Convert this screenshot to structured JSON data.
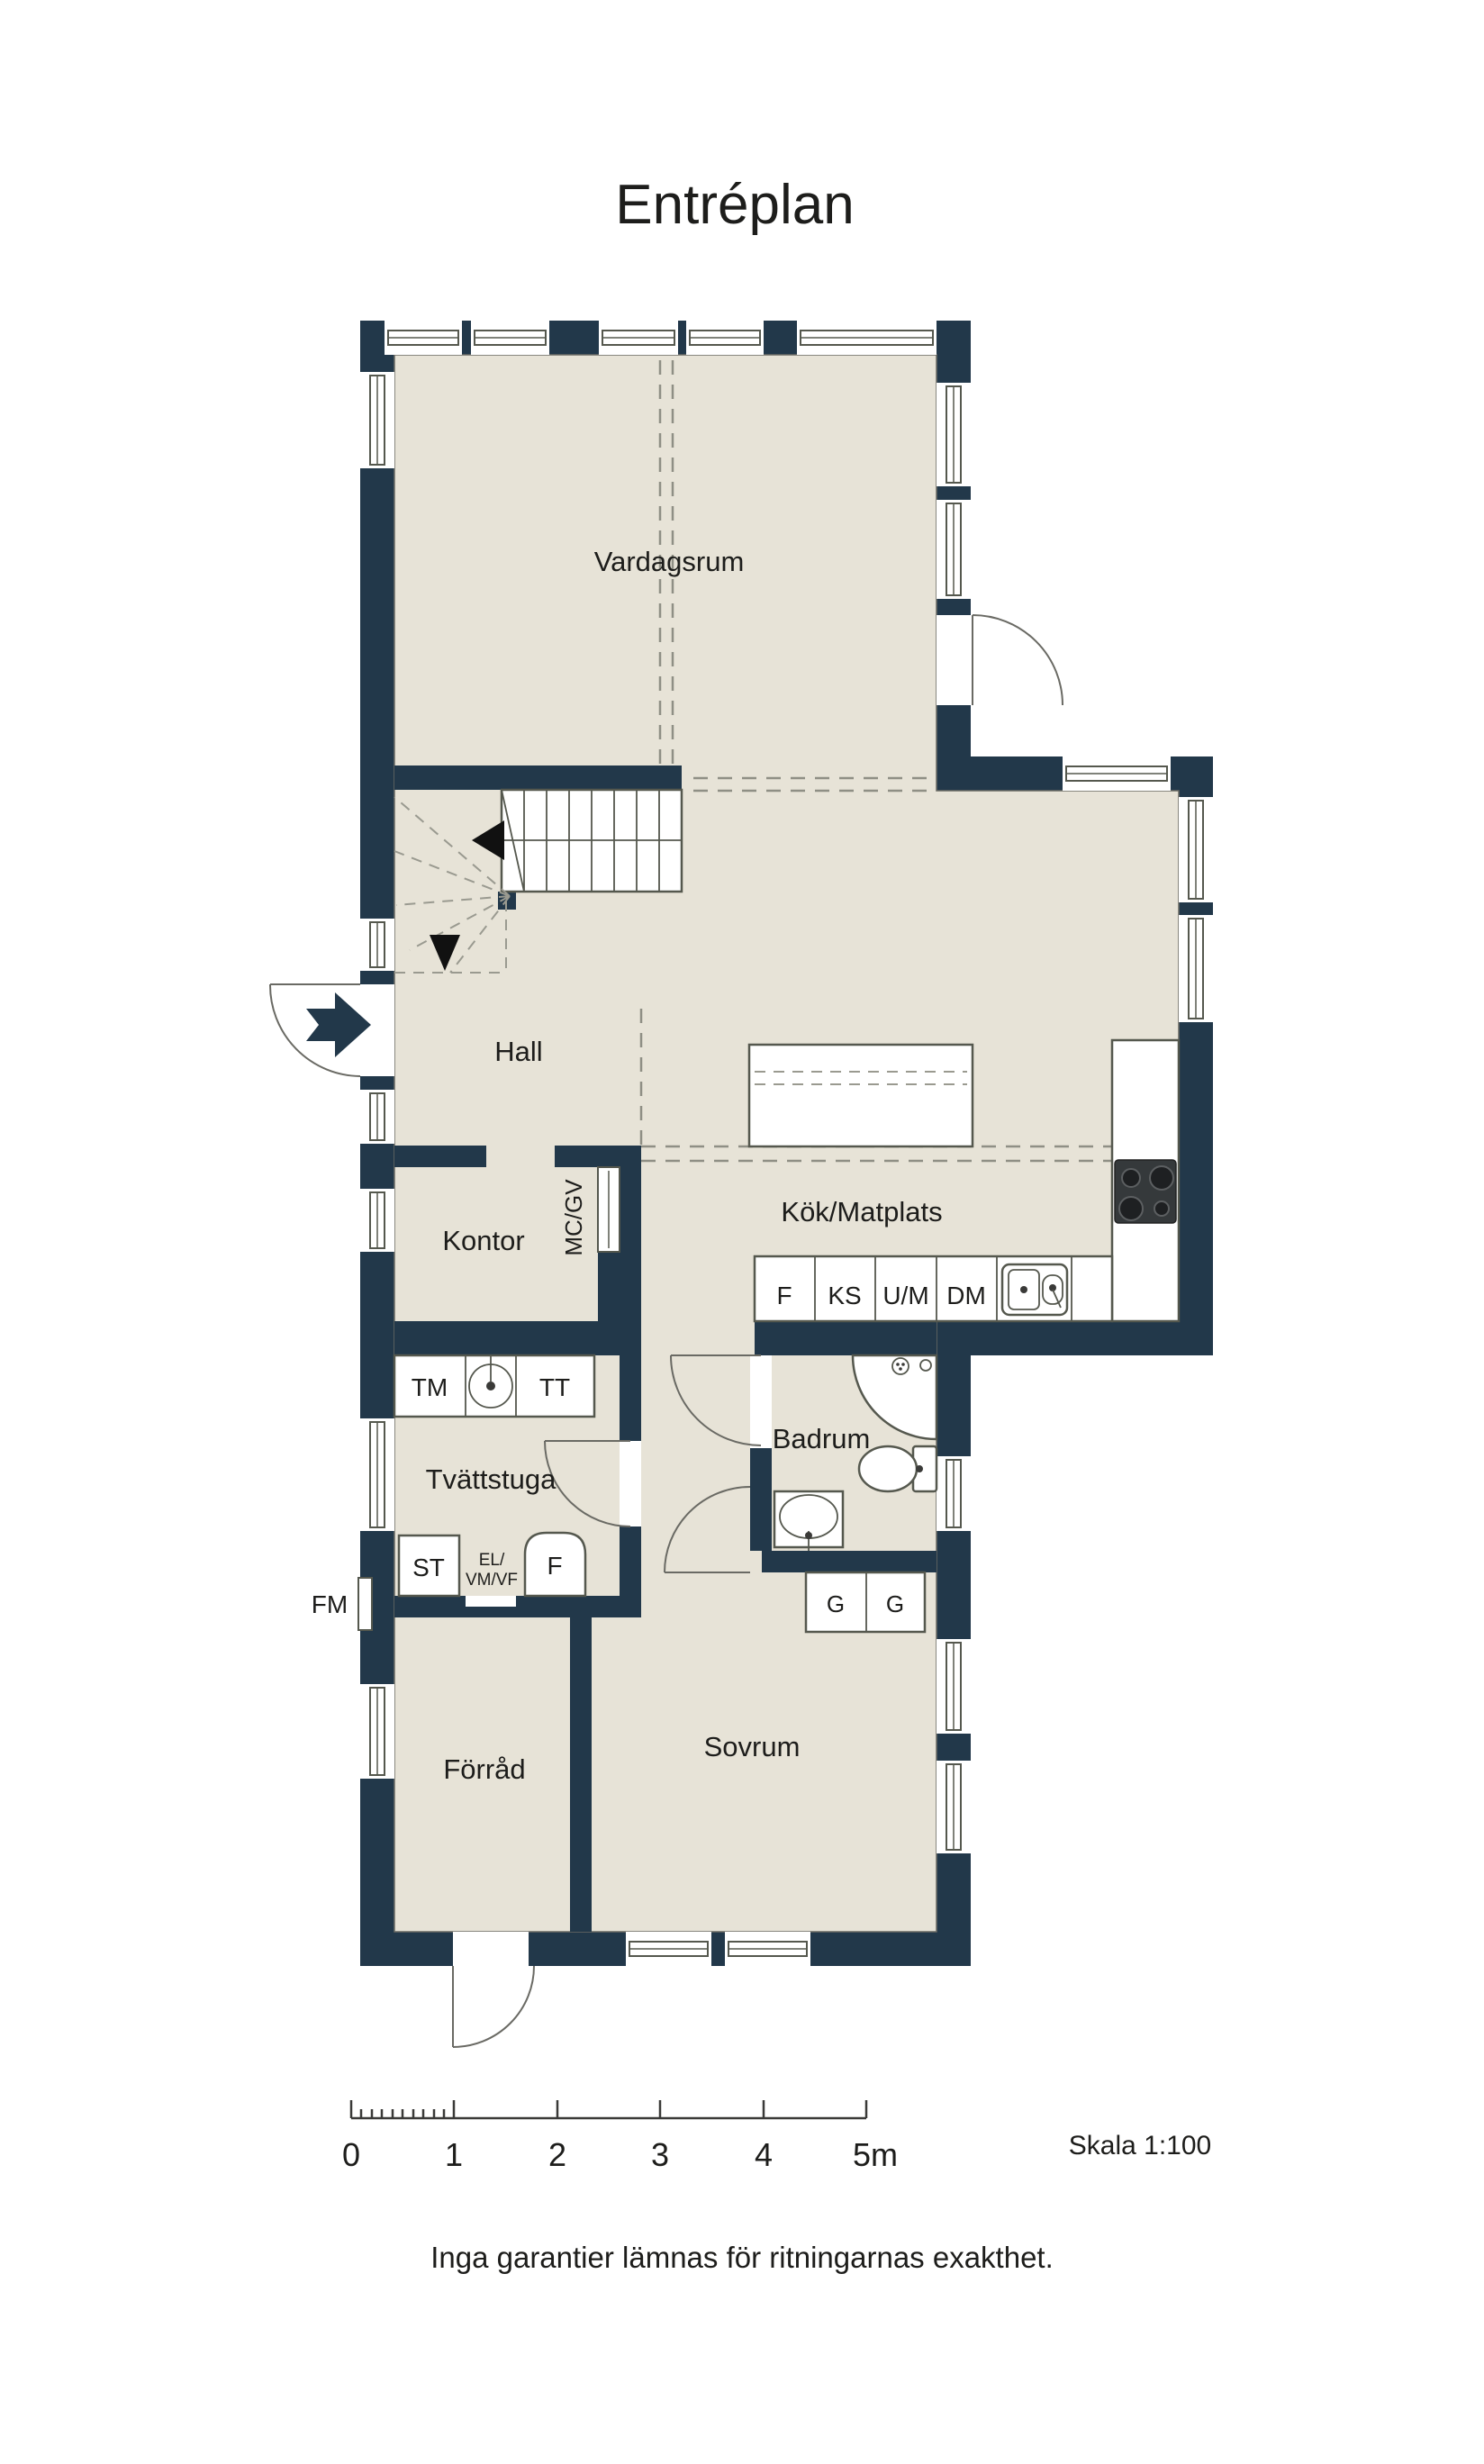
{
  "title": "Entréplan",
  "plan": {
    "rooms": {
      "vardagsrum": "Vardagsrum",
      "hall": "Hall",
      "kontor": "Kontor",
      "kok_matplats": "Kök/Matplats",
      "badrum": "Badrum",
      "tvattstuga": "Tvättstuga",
      "forrad": "Förråd",
      "sovrum": "Sovrum"
    },
    "labels": {
      "mc_gv": "MC/GV",
      "tm": "TM",
      "tt": "TT",
      "f_kitchen": "F",
      "ks": "KS",
      "um": "U/M",
      "dm": "DM",
      "st": "ST",
      "el_line1": "EL/",
      "el_line2": "VM/VF",
      "f_laundry": "F",
      "fm": "FM",
      "g_left": "G",
      "g_right": "G"
    }
  },
  "scale_bar": {
    "tick_labels": [
      "0",
      "1",
      "2",
      "3",
      "4",
      "5m"
    ],
    "scale_label": "Skala 1:100"
  },
  "footer": {
    "disclaimer": "Inga garantier lämnas för ritningarnas exakthet."
  },
  "colors": {
    "wall": "#22384a",
    "floor": "#e7e3d7",
    "frame_line": "#55584e",
    "dash_line": "#8f8f85",
    "text": "#1d1d1b"
  }
}
